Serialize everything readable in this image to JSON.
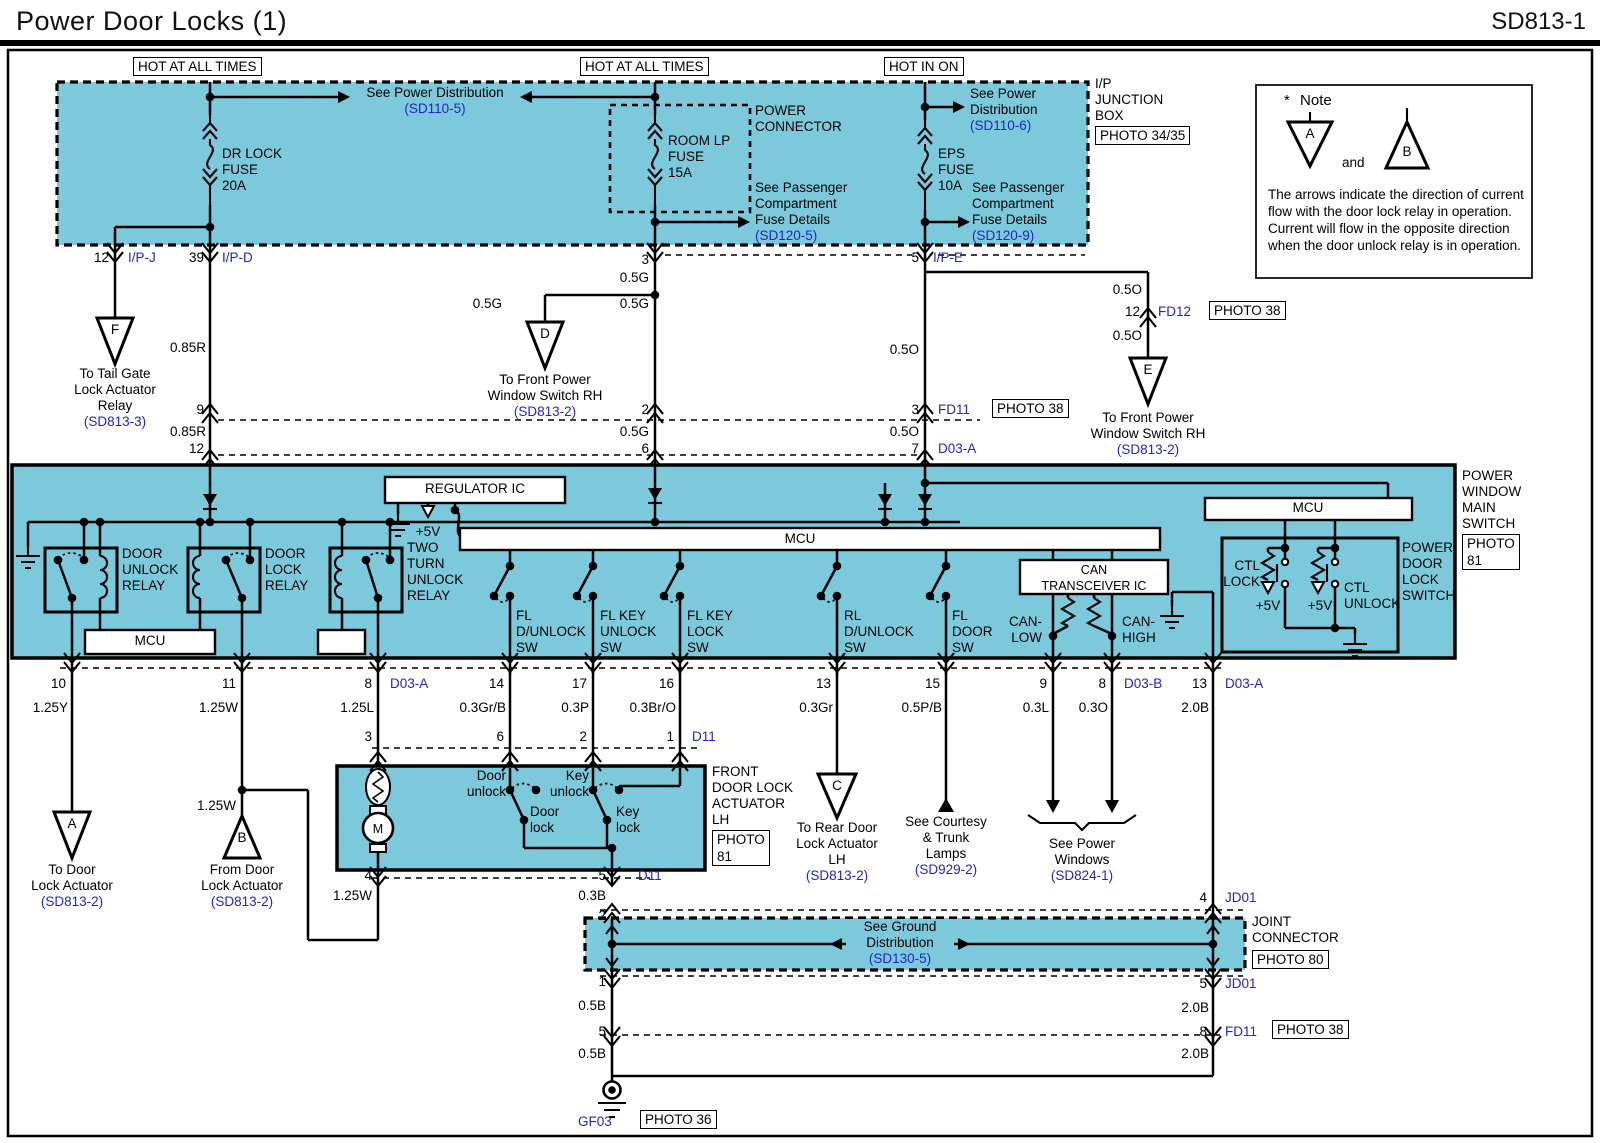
{
  "header": {
    "title": "Power Door Locks (1)",
    "code": "SD813-1"
  },
  "colors": {
    "cyan": "#7cc9dc",
    "blue": "#2323cb",
    "line": "#000000"
  },
  "banners": {
    "hot_all_1": "HOT AT ALL TIMES",
    "hot_all_2": "HOT AT ALL TIMES",
    "hot_in_on": "HOT IN ON"
  },
  "fuses": {
    "dr_lock": [
      "DR LOCK",
      "FUSE",
      "20A"
    ],
    "room_lp": [
      "ROOM LP",
      "FUSE",
      "15A"
    ],
    "eps": [
      "EPS",
      "FUSE",
      "10A"
    ]
  },
  "boxes": {
    "power_connector": [
      "POWER",
      "CONNECTOR"
    ],
    "ip_junction": [
      "I/P",
      "JUNCTION",
      "BOX"
    ],
    "joint": [
      "JOINT",
      "CONNECTOR"
    ],
    "photo3435": "PHOTO 34/35",
    "photo38": "PHOTO 38",
    "photo80": "PHOTO 80",
    "photo81": [
      "PHOTO",
      "81"
    ],
    "photo36": "PHOTO 36"
  },
  "note": {
    "star": "*",
    "title": "Note",
    "a": "A",
    "b": "B",
    "and": "and",
    "body": "The arrows indicate the direction of current flow with the door lock relay in operation. Current will flow in the opposite direction when the door unlock relay is in operation."
  },
  "tri": {
    "a": "A",
    "b": "B",
    "c": "C",
    "d": "D",
    "e": "E",
    "f": "F"
  },
  "refs": {
    "pd5": {
      "l1": "See Power Distribution",
      "code": "(SD110-5)"
    },
    "pd6": {
      "l1": "See Power",
      "l2": "Distribution",
      "code": "(SD110-6)"
    },
    "pc5": {
      "l1": "See Passenger",
      "l2": "Compartment",
      "l3": "Fuse Details",
      "code": "(SD120-5)"
    },
    "pc9": {
      "l1": "See Passenger",
      "l2": "Compartment",
      "l3": "Fuse Details",
      "code": "(SD120-9)"
    },
    "tailgate": {
      "l1": "To Tail Gate",
      "l2": "Lock Actuator",
      "l3": "Relay",
      "code": "(SD813-3)"
    },
    "fpws_d": {
      "l1": "To Front Power",
      "l2": "Window Switch RH",
      "code": "(SD813-2)"
    },
    "fpws_e": {
      "l1": "To Front Power",
      "l2": "Window Switch RH",
      "code": "(SD813-2)"
    },
    "door_act_a": {
      "l1": "To Door",
      "l2": "Lock Actuator",
      "code": "(SD813-2)"
    },
    "door_act_b": {
      "l1": "From Door",
      "l2": "Lock Actuator",
      "code": "(SD813-2)"
    },
    "rear_act": {
      "l1": "To Rear Door",
      "l2": "Lock Actuator",
      "l3": "LH",
      "code": "(SD813-2)"
    },
    "courtesy": {
      "l1": "See Courtesy",
      "l2": "& Trunk",
      "l3": "Lamps",
      "code": "(SD929-2)"
    },
    "power_windows": {
      "l1": "See Power",
      "l2": "Windows",
      "code": "(SD824-1)"
    },
    "ground_dist": {
      "l1": "See Ground",
      "l2": "Distribution",
      "code": "(SD130-5)"
    }
  },
  "main_switch": {
    "name": [
      "POWER",
      "WINDOW",
      "MAIN",
      "SWITCH"
    ],
    "regulator": "REGULATOR IC",
    "mcu": "MCU",
    "plus5v": "+5V",
    "relay_unlock": [
      "DOOR",
      "UNLOCK",
      "RELAY"
    ],
    "relay_lock": [
      "DOOR",
      "LOCK",
      "RELAY"
    ],
    "relay_twoturn": [
      "TWO",
      "TURN",
      "UNLOCK",
      "RELAY"
    ],
    "sw_fl_dunlock": [
      "FL",
      "D/UNLOCK",
      "SW"
    ],
    "sw_flkey_unlock": [
      "FL KEY",
      "UNLOCK",
      "SW"
    ],
    "sw_flkey_lock": [
      "FL KEY",
      "LOCK",
      "SW"
    ],
    "sw_rl_dunlock": [
      "RL",
      "D/UNLOCK",
      "SW"
    ],
    "sw_fl_door": [
      "FL",
      "DOOR",
      "SW"
    ],
    "can": [
      "CAN",
      "TRANSCEIVER IC"
    ],
    "can_low": [
      "CAN-",
      "LOW"
    ],
    "can_high": [
      "CAN-",
      "HIGH"
    ],
    "ctl_lock": [
      "CTL",
      "LOCK"
    ],
    "ctl_unlock": [
      "CTL",
      "UNLOCK"
    ],
    "pdls": [
      "POWER",
      "DOOR",
      "LOCK",
      "SWITCH"
    ]
  },
  "actuator": {
    "name": [
      "FRONT",
      "DOOR LOCK",
      "ACTUATOR",
      "LH"
    ],
    "motor": "M",
    "door_unlock": [
      "Door",
      "unlock"
    ],
    "key_unlock": [
      "Key",
      "unlock"
    ],
    "door_lock": [
      "Door",
      "lock"
    ],
    "key_lock": [
      "Key",
      "lock"
    ]
  },
  "conn": {
    "ipj": "I/P-J",
    "ipd": "I/P-D",
    "ipe": "I/P-E",
    "d03a": "D03-A",
    "d03b": "D03-B",
    "d11": "D11",
    "fd11": "FD11",
    "fd12": "FD12",
    "jd01": "JD01",
    "gf03": "GF03"
  },
  "pins": {
    "p1": "1",
    "p2": "2",
    "p3": "3",
    "p4": "4",
    "p5": "5",
    "p6": "6",
    "p7": "7",
    "p8": "8",
    "p9": "9",
    "p10": "10",
    "p11": "11",
    "p12": "12",
    "p13": "13",
    "p14": "14",
    "p15": "15",
    "p16": "16",
    "p17": "17",
    "p39": "39"
  },
  "wires": {
    "w085r": "0.85R",
    "w05g": "0.5G",
    "w05o": "0.5O",
    "w125y": "1.25Y",
    "w125w": "1.25W",
    "w125l": "1.25L",
    "w03grb": "0.3Gr/B",
    "w03p": "0.3P",
    "w03bro": "0.3Br/O",
    "w03gr": "0.3Gr",
    "w05pb": "0.5P/B",
    "w03l": "0.3L",
    "w03o": "0.3O",
    "w20b": "2.0B",
    "w03b": "0.3B",
    "w05b": "0.5B"
  }
}
